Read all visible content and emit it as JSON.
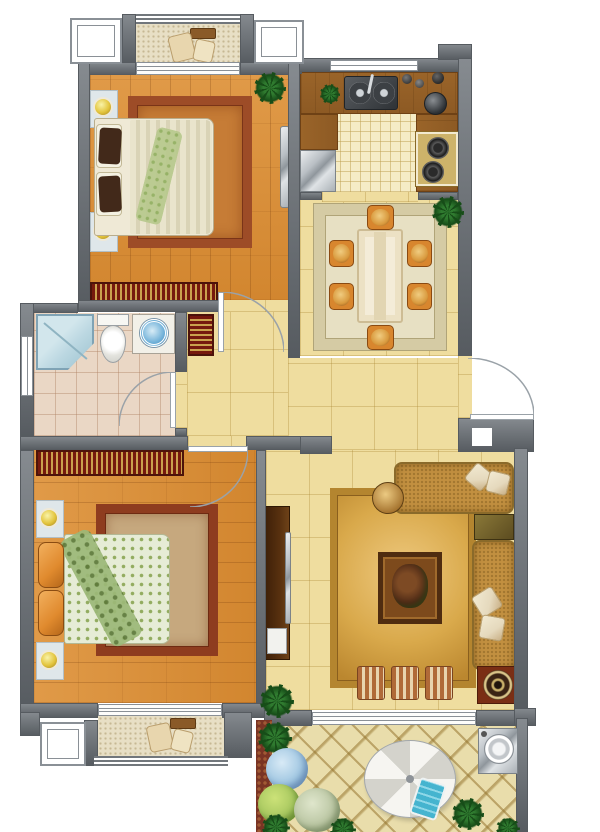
{
  "meta": {
    "type": "residential floor plan, rendered top-down color illustration",
    "canvas": {
      "width": 600,
      "height": 832
    },
    "visible_text": "none"
  },
  "palette": {
    "wall": "#72777c",
    "wallHi": "#868b90",
    "wallEdge": "#565b60",
    "frame": "#8a9096",
    "doorLine": "#9aa2a8",
    "woodA": "#e09a48",
    "woodB": "#d2862f",
    "woodLine": "rgba(100,45,5,0.22)",
    "tile": "#efdd9f",
    "tileLine": "rgba(168,132,46,0.32)",
    "ktile": "#f5ecc6",
    "ktileLine": "rgba(190,160,80,0.5)",
    "counter": "#8d5a24",
    "counterDark": "#6e4115",
    "bathTile": "#ead7c5",
    "bathLine": "rgba(175,130,100,0.42)",
    "terr": "#e9ddab",
    "terrLine": "rgba(150,118,48,0.55)",
    "speck": "#e8dfc5",
    "speckDot": "rgba(150,130,80,0.42)",
    "wardA": "#76190d",
    "wardB": "#caa14d",
    "wardEdge": "#4c130a",
    "rug1A": "#9d4c27",
    "rug1B": "#c67c36",
    "rug2A": "#d5cba4",
    "rug2B": "#e7e0c3",
    "rug3A": "#b4852f",
    "rug3B": "#d9a94b",
    "rug4A": "#8e3c1f",
    "rug4B": "#c6a87e",
    "sofa": "#c29040",
    "sofaDot": "rgba(90,60,10,0.3)",
    "pillow": "#e5d9bd",
    "pillowEdge": "#b9a275",
    "chair": "#d8862e",
    "chairEdge": "#8a4a12",
    "cushion": "#d99a3e",
    "tableTop": "#f4ecd8",
    "tableEdge": "#cdbc94",
    "shower": "#bcd8e2",
    "showerEdge": "#7fa3b5",
    "lamp": "#e3c53e",
    "plantDark": "#174d18",
    "plantMid": "#2f7a2f",
    "mat": "#dfe7ea",
    "matEdge": "#b2bfc6",
    "orange": "#e08a2e",
    "tvCab": "#57300f",
    "screen": "#c9ccce",
    "speakerBox": "#7a2e14",
    "otto": "#b06a38",
    "coffeeA": "#4f2c10",
    "coffeeB": "#7d4a1c",
    "blue": "#45b4cf",
    "quilt1A": "#e9e4cc",
    "quilt1B": "#d9d3b6",
    "quilt2": "#e6ecd6",
    "quiltDot": "#93ac60",
    "throw": "#9cb878",
    "darkPillow": "#42291a",
    "maroon": "#7a3424"
  },
  "rooms": [
    {
      "name": "balcony-top",
      "floor": "speckled screed",
      "furniture": [
        "lounge chair",
        "small table"
      ],
      "features": [
        "railing",
        "bay window left",
        "bay window right",
        "sliding door to bedroom-1"
      ]
    },
    {
      "name": "bedroom-1",
      "floor": "orange wood planks",
      "furniture": [
        "double bed with dark pillows",
        "nightstand with lamp (2)",
        "ornate area rug",
        "wall-mounted tv panel",
        "striped bookshelf wardrobe",
        "potted plant"
      ],
      "features": [
        "hinged door to hallway"
      ]
    },
    {
      "name": "kitchen",
      "floor": "cream grid tile",
      "furniture": [
        "L counter",
        "double sink",
        "refrigerator",
        "two-burner stove",
        "kettle",
        "herb pot",
        "jars"
      ],
      "features": [
        "window on top wall",
        "open pass to dining"
      ]
    },
    {
      "name": "dining-room",
      "floor": "pale yellow tile",
      "furniture": [
        "dining table",
        "chair (6)",
        "patterned rug",
        "potted plant"
      ],
      "features": [
        "entry door on right wall"
      ]
    },
    {
      "name": "bathroom",
      "floor": "pink grid tile",
      "furniture": [
        "corner shower",
        "toilet",
        "vanity with blue basin"
      ],
      "features": [
        "window on left wall",
        "hinged door to hallway"
      ]
    },
    {
      "name": "hallway",
      "floor": "pale yellow tile",
      "furniture": [
        "striped shoe cabinet"
      ]
    },
    {
      "name": "bedroom-2",
      "floor": "orange wood planks",
      "furniture": [
        "double bed with orange pillows",
        "nightstand with lamp (2)",
        "ornate area rug",
        "striped wardrobe"
      ],
      "features": [
        "hinged door to hallway",
        "sliding door to balcony-bottom"
      ]
    },
    {
      "name": "living-room",
      "floor": "pale yellow tile",
      "furniture": [
        "L-shaped sofa with pillows",
        "corner table",
        "round side table",
        "golden rug",
        "coffee table with plant",
        "ottoman (3)",
        "floor speaker",
        "tv cabinet with tv",
        "potted plant"
      ],
      "features": [
        "sliding door to terrace"
      ]
    },
    {
      "name": "balcony-bottom",
      "floor": "speckled screed",
      "furniture": [
        "chair",
        "small table"
      ],
      "features": [
        "railing",
        "bay window"
      ]
    },
    {
      "name": "terrace",
      "floor": "diamond lattice tile",
      "furniture": [
        "parasol umbrella",
        "blue lounge chair",
        "washing machine"
      ],
      "features": [
        "planting bed with shrubs",
        "hydrangea",
        "palms"
      ]
    }
  ]
}
